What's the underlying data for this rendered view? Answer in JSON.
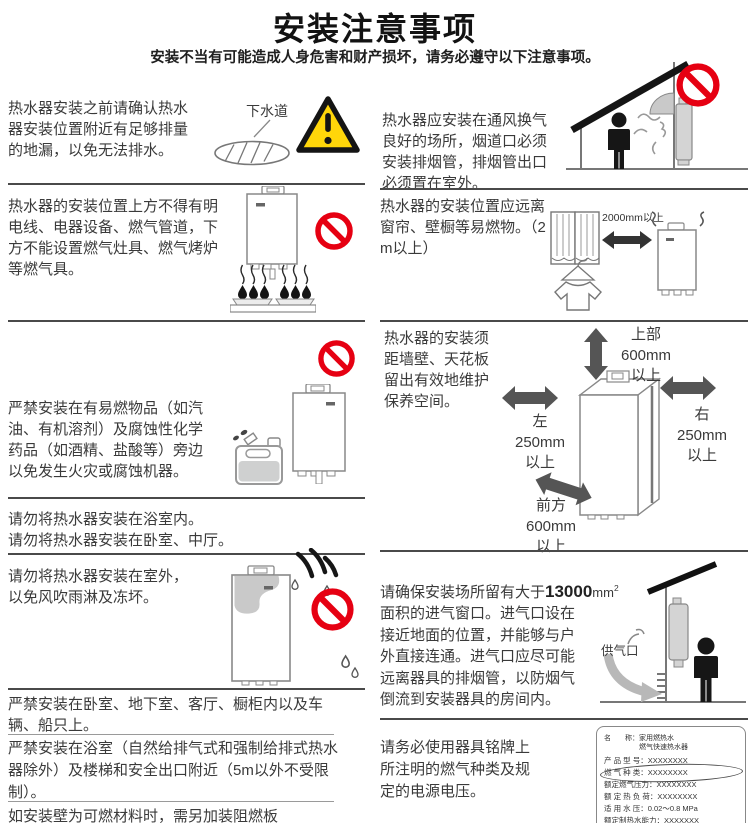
{
  "header": {
    "title": "安装注意事项",
    "subtitle": "安装不当有可能造成人身危害和财产损坏，请务必遵守以下注意事项。"
  },
  "colors": {
    "prohibition_red": "#e60012",
    "warning_yellow": "#ffd60a"
  },
  "left": {
    "s1": {
      "text": "热水器安装之前请确认热水器安装位置附近有足够排量的地漏，以免无法排水。",
      "drain_label": "下水道"
    },
    "s2": {
      "text": "热水器的安装位置上方不得有明电线、电器设备、燃气管道，下方不能设置燃气灶具、燃气烤炉等燃气具。"
    },
    "s3": {
      "text": "严禁安装在有易燃物品（如汽油、有机溶剂）及腐蚀性化学药品（如酒精、盐酸等）旁边以免发生火灾或腐蚀机器。"
    },
    "s4": {
      "line1": "请勿将热水器安装在浴室内。",
      "line2": "请勿将热水器安装在卧室、中厅。"
    },
    "s5": {
      "text": "请勿将热水器安装在室外，以免风吹雨淋及冻坏。"
    },
    "s6": {
      "text": "严禁安装在卧室、地下室、客厅、橱柜内以及车辆、船只上。"
    },
    "s7": {
      "text": "严禁安装在浴室（自然给排气式和强制给排式热水器除外）及楼梯和安全出口附近（5m以外不受限制）。"
    },
    "s8": {
      "text": "如安装壁为可燃材料时，需另加装阻燃板"
    }
  },
  "right": {
    "s1": {
      "text": "热水器应安装在通风换气良好的场所，烟道口必须安装排烟管，排烟管出口必须置在室外。"
    },
    "s2": {
      "text": "热水器的安装位置应远离窗帘、壁橱等易燃物。（2m以上）",
      "arrow_label": "2000mm以上"
    },
    "s3": {
      "text": "热水器的安装须距墙壁、天花板留出有效地维护保养空间。",
      "label_top": "上部\n600mm\n以上",
      "label_left": "左\n250mm\n以上",
      "label_right": "右\n250mm\n以上",
      "label_front": "前方\n600mm\n以上"
    },
    "s4": {
      "t1": "请确保安装场所留有大于",
      "big": "13000",
      "unit": "mm",
      "sup": "2",
      "t2": "面积的进气窗口。进气口设在接近地面的位置，并能够与户外直接连通。进气口应尽可能远离器具的排烟管，以防烟气倒流到安装器具的房间内。",
      "inlet_label": "供气口"
    },
    "s5": {
      "text": "请务必使用器具铭牌上所注明的燃气种类及规定的电源电压。",
      "plate_rows": [
        "名　　称：家用燃热水",
        "　　　　　燃气快速热水器",
        "产 品 型 号：XXXXXXXX",
        "燃 气 种 类：XXXXXXXX",
        "额定燃气压力：XXXXXXXX",
        "额 定 热 负 荷：XXXXXXXX",
        "适 用 水 压：0.02～0.8 MPa",
        "额定制热水能力：XXXXXXX"
      ]
    }
  }
}
